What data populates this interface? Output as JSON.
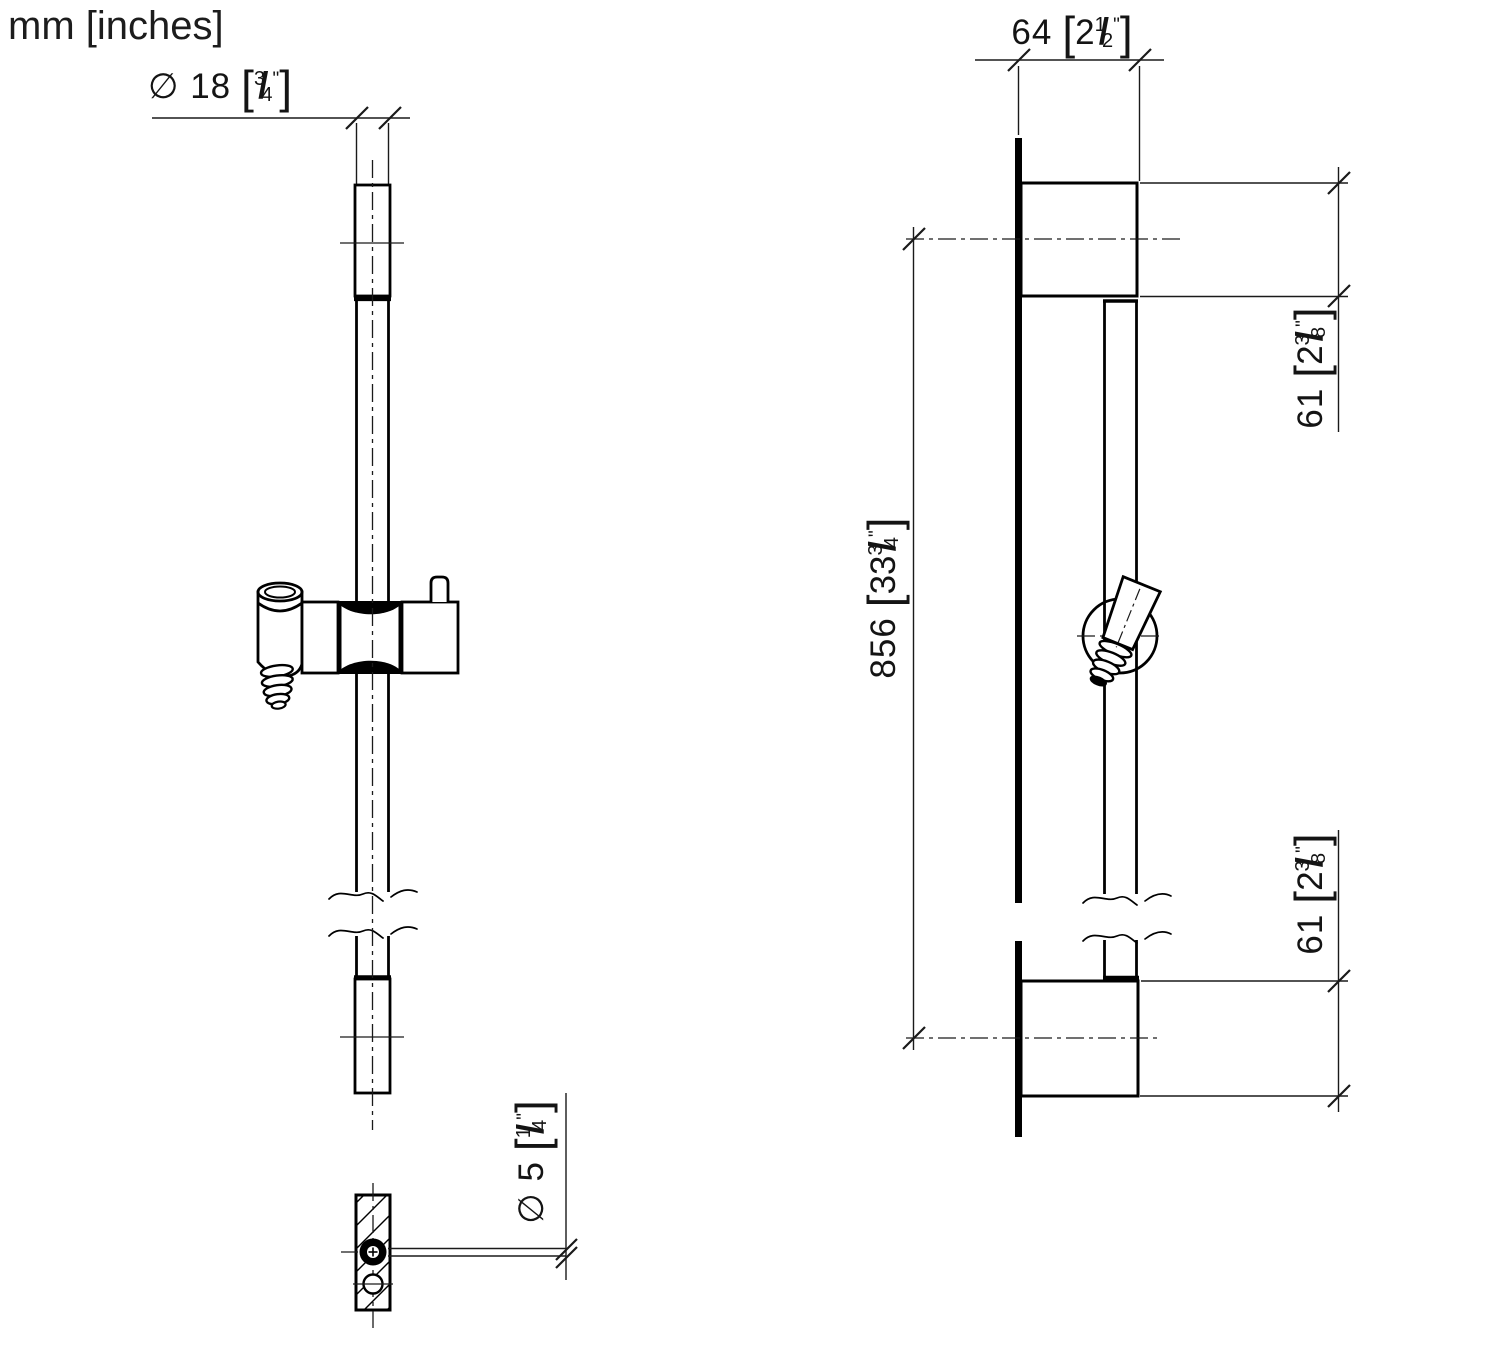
{
  "units_note": "mm [inches]",
  "symbols": {
    "bracket_open": "[",
    "bracket_close": "]",
    "fraction_slash": "/",
    "inch_mark": "\""
  },
  "dimensions": {
    "rail_diameter": {
      "metric": "∅ 18",
      "inch_whole": "",
      "frac_num": "3",
      "frac_den": "4"
    },
    "bracket_depth": {
      "metric": "64",
      "inch_whole": "2",
      "frac_num": "1",
      "frac_den": "2"
    },
    "top_offset": {
      "metric": "61",
      "inch_whole": "2",
      "frac_num": "3",
      "frac_den": "8"
    },
    "rail_length": {
      "metric": "856",
      "inch_whole": "33",
      "frac_num": "3",
      "frac_den": "4"
    },
    "bottom_offset": {
      "metric": "61",
      "inch_whole": "2",
      "frac_num": "3",
      "frac_den": "8"
    },
    "screw_hole_diameter": {
      "metric": "∅ 5",
      "inch_whole": "",
      "frac_num": "1",
      "frac_den": "4"
    }
  }
}
